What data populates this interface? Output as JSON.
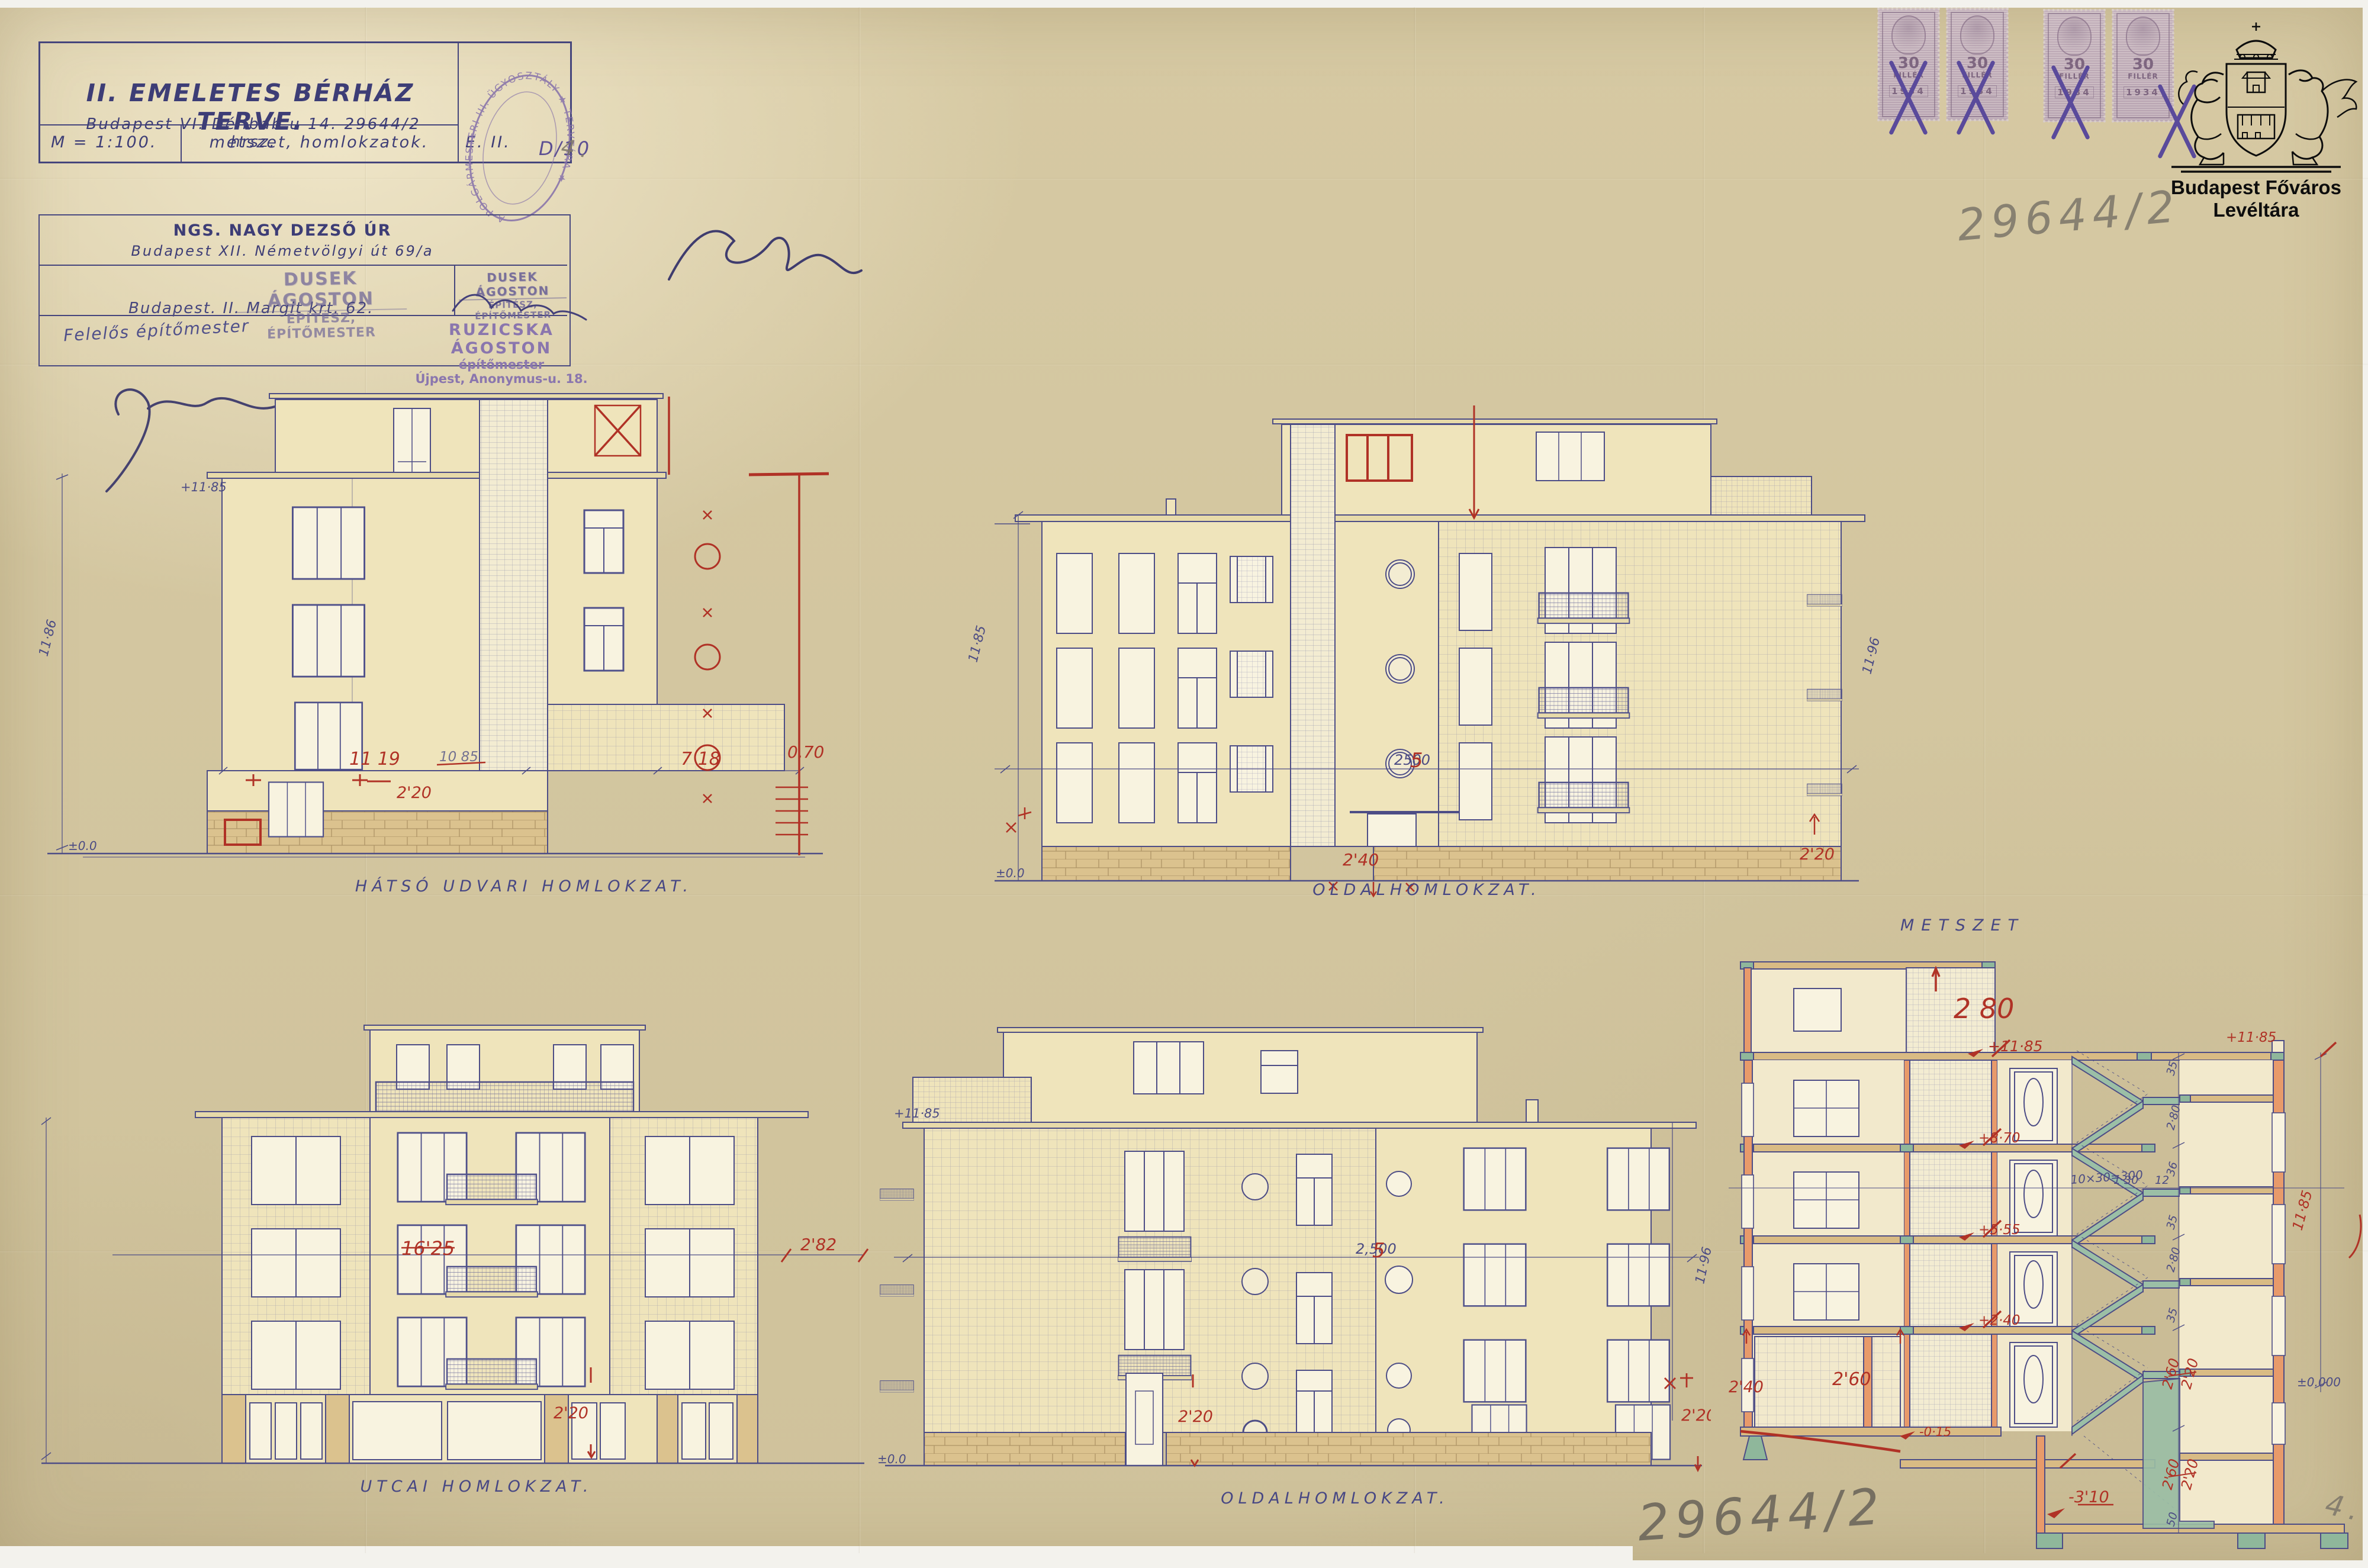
{
  "archive": {
    "institution": "Budapest Főváros Levéltára",
    "file_number": "29644/2",
    "file_number_bottom": "29644/2",
    "sheet_pencil": "4.",
    "sheet_pencil_bottom": "4."
  },
  "title_block": {
    "title": "II. EMELETES BÉRHÁZ TERVE.",
    "address": "Budapest VI. Délibab u 14.   29644/2 hrsz.",
    "scale": "M = 1:100.",
    "contents": "metszet, homlokzatok.",
    "sheet": "E. II.",
    "round_stamp": "A POLGÁRMESTERI III. ÜGYOSZTÁLY ★ TERVTÁRA ★",
    "round_stamp_note": "D/10"
  },
  "parties": {
    "client_line1": "NGS. NAGY DEZSŐ ÚR",
    "client_line2": "Budapest XII.   Németvölgyi út 69/a",
    "architect_stamp1": "DUSEK ÁGOSTON",
    "architect_stamp2": "ÉPÍTÉSZ, ÉPÍTŐMESTER",
    "architect_addr": "Budapest. II. Margit krt. 62.",
    "resp_note": "Felelős építőmester",
    "builder_stamp1": "RUZICSKA ÁGOSTON",
    "builder_stamp2": "építőmester",
    "builder_stamp3": "Újpest, Anonymus-u. 18."
  },
  "revenue_stamp": {
    "value": "30",
    "currency": "FILLÉR",
    "year": "1934"
  },
  "rear": {
    "label": "HÁTSÓ UDVARI HOMLOKZAT.",
    "ann": {
      "level_top": "+11·85",
      "height_left": "11·86",
      "ground": "±0.0",
      "dim_a": "11 19",
      "dim_a_old": "10 85",
      "dim_b": "7 18",
      "dim_c": "0.70",
      "dim_d": "2'20"
    }
  },
  "side_top": {
    "label": "OLDALHOMLOKZAT.",
    "ann": {
      "height_left": "11·85",
      "height_right": "11·96",
      "ground": "±0.0",
      "dim_mid": "2500",
      "dim_mid_fix": "5",
      "dim_door": "2'40",
      "dim_right": "2'20"
    }
  },
  "street": {
    "label": "UTCAI HOMLOKZAT.",
    "ann": {
      "dim_main": "16'25",
      "dim_right": "2'82",
      "dim_shop": "2'20"
    }
  },
  "side_bottom": {
    "label": "OLDALHOMLOKZAT.",
    "ann": {
      "level_top": "+11·85",
      "ground": "±0.0",
      "height_right": "11·96",
      "dim_mid": "2,500",
      "dim_mid_fix": "5",
      "dim_door": "2'20",
      "dim_right": "2'20"
    }
  },
  "section": {
    "label": "METSZET",
    "ann": {
      "room_height": "2 80",
      "level_roof": "+11·85",
      "level_3": "+8·70",
      "level_2": "+5·55",
      "level_1": "+2·40",
      "level_ground": "-0·15",
      "level_basement": "-3'10",
      "level_zero": "±0.000",
      "stair_formula": "10×30=300",
      "dim_130": "1 30",
      "dim_12": "12",
      "chain": [
        "35",
        "2·80",
        "36",
        "35",
        "2·80",
        "35",
        "50"
      ],
      "fix_a_old": "2'60",
      "fix_a_new": "2'20",
      "fix_b_old": "2'60",
      "fix_b_new": "2'20",
      "dim_240": "2'40",
      "dim_260": "2'60",
      "height_right": "11·85",
      "level_top_right": "+11·85"
    }
  }
}
